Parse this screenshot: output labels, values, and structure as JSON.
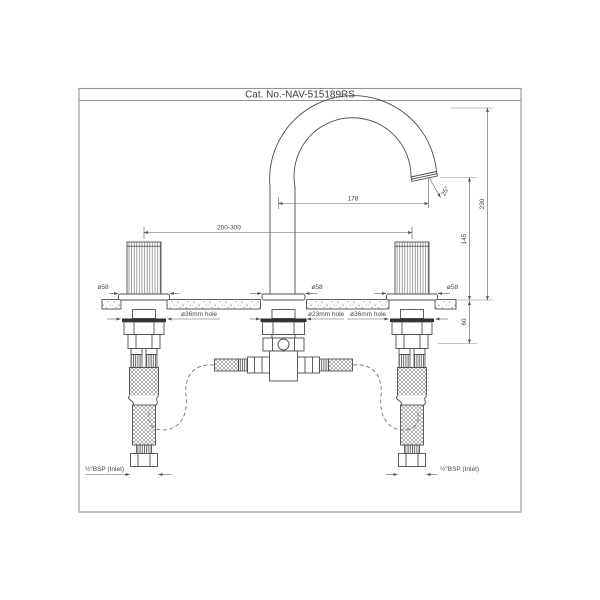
{
  "title": "Cat. No.-NAV-515189RS",
  "dimensions": {
    "spout_reach": "178",
    "overall_height": "230",
    "outlet_height": "145",
    "handle_centers": "200-300",
    "max_counter_thickness": "60",
    "flow_angle": "25°",
    "body_diameter": "ø58",
    "handle_hole": "ø36mm hole",
    "spout_hole": "ø23mm hole",
    "inlet_connection": "½\"BSP (Inlet)"
  },
  "colors": {
    "line": "#4d4d4d",
    "dimension": "#5a5a5a",
    "border": "#949494",
    "text": "#3a3a3a",
    "background": "#ffffff"
  }
}
